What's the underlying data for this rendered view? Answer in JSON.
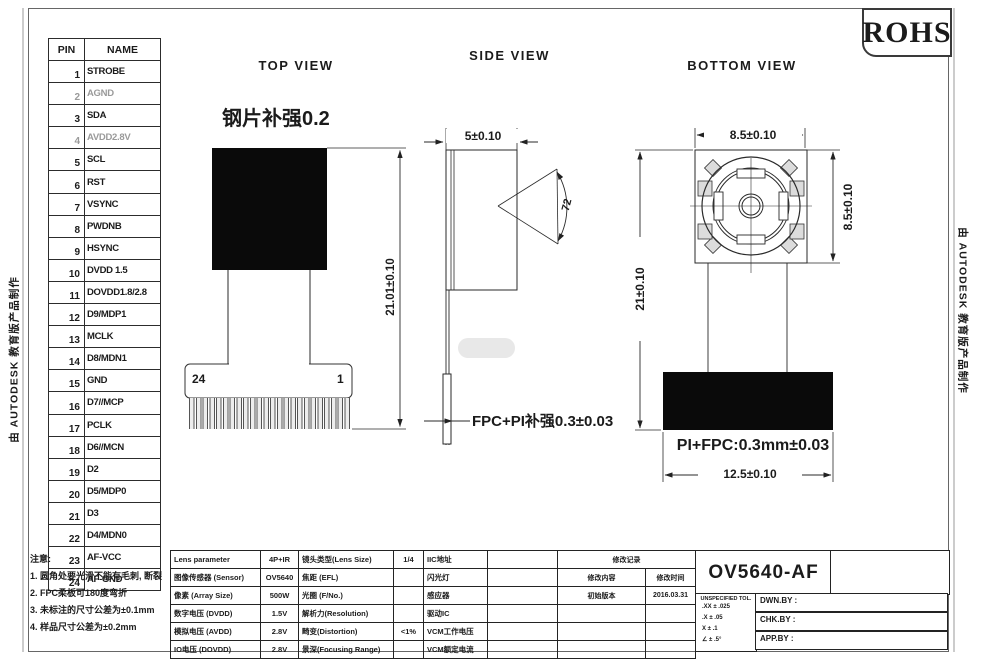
{
  "badge": {
    "rohs": "ROHS"
  },
  "watermarks": {
    "left": "由 AUTODESK 教育版产品制作",
    "right": "由 AUTODESK 教育版产品制作"
  },
  "pin_table": {
    "pin_header": "PIN",
    "name_header": "NAME",
    "muted_pins": [
      "2",
      "4"
    ],
    "rows": [
      {
        "pin": "1",
        "name": "STROBE"
      },
      {
        "pin": "2",
        "name": "AGND"
      },
      {
        "pin": "3",
        "name": "SDA"
      },
      {
        "pin": "4",
        "name": "AVDD2.8V"
      },
      {
        "pin": "5",
        "name": "SCL"
      },
      {
        "pin": "6",
        "name": "RST"
      },
      {
        "pin": "7",
        "name": "VSYNC"
      },
      {
        "pin": "8",
        "name": "PWDNB"
      },
      {
        "pin": "9",
        "name": "HSYNC"
      },
      {
        "pin": "10",
        "name": "DVDD 1.5"
      },
      {
        "pin": "11",
        "name": "DOVDD1.8/2.8"
      },
      {
        "pin": "12",
        "name": "D9/MDP1"
      },
      {
        "pin": "13",
        "name": "MCLK"
      },
      {
        "pin": "14",
        "name": "D8/MDN1"
      },
      {
        "pin": "15",
        "name": "GND"
      },
      {
        "pin": "16",
        "name": "D7//MCP"
      },
      {
        "pin": "17",
        "name": "PCLK"
      },
      {
        "pin": "18",
        "name": "D6//MCN"
      },
      {
        "pin": "19",
        "name": "D2"
      },
      {
        "pin": "20",
        "name": "D5/MDP0"
      },
      {
        "pin": "21",
        "name": "D3"
      },
      {
        "pin": "22",
        "name": "D4/MDN0"
      },
      {
        "pin": "23",
        "name": "AF-VCC"
      },
      {
        "pin": "24",
        "name": "AF-GND"
      }
    ]
  },
  "views": {
    "top": {
      "title": "TOP VIEW",
      "stiffener_note": "钢片补强0.2",
      "height_dim": "21.01±0.10",
      "pin24": "24",
      "pin1": "1"
    },
    "side": {
      "title": "SIDE VIEW",
      "width_dim": "5±0.10",
      "fov_deg": "72",
      "fpc_note": "FPC+PI补强0.3±0.03"
    },
    "bottom": {
      "title": "BOTTOM VIEW",
      "width_dim": "8.5±0.10",
      "height_dim": "8.5±0.10",
      "total_height_dim": "21±0.10",
      "fpc_note": "PI+FPC:0.3mm±0.03",
      "base_width_dim": "12.5±0.10"
    }
  },
  "notes": {
    "title": "注意:",
    "items": [
      "1. 圆角处要光滑不能有毛刺, 断裂",
      "2. FPC柔板可180度弯折",
      "3. 未标注的尺寸公差为±0.1mm",
      "4. 样品尺寸公差为±0.2mm"
    ]
  },
  "spec_table": {
    "rows": [
      [
        "Lens parameter",
        "4P+IR",
        "镜头类型(Lens Size)",
        "1/4",
        "IIC地址",
        ""
      ],
      [
        "图像传感器 (Sensor)",
        "OV5640",
        "焦距 (EFL)",
        "",
        "闪光灯",
        ""
      ],
      [
        "像素 (Array Size)",
        "500W",
        "光圈 (F/No.)",
        "",
        "感应器",
        ""
      ],
      [
        "数字电压 (DVDD)",
        "1.5V",
        "解析力(Resolution)",
        "",
        "驱动IC",
        ""
      ],
      [
        "模拟电压 (AVDD)",
        "2.8V",
        "畸变(Distortion)",
        "<1%",
        "VCM工作电压",
        ""
      ],
      [
        "IO电压 (DOVDD)",
        "2.8V",
        "景深(Focusing Range)",
        "",
        "VCM额定电流",
        ""
      ]
    ]
  },
  "revision": {
    "rows": [
      {
        "colspan": 2,
        "cells": [
          "修改记录"
        ]
      },
      {
        "cells": [
          "修改内容",
          "修改时间"
        ]
      },
      {
        "cells": [
          "初始版本",
          "2016.03.31"
        ]
      },
      {
        "cells": [
          "",
          ""
        ]
      },
      {
        "cells": [
          "",
          ""
        ]
      },
      {
        "cells": [
          "",
          ""
        ]
      }
    ]
  },
  "title_block": {
    "part_no": "OV5640-AF",
    "tol_header": "UNSPECIFIED TOL.",
    "tol_rows": [
      ".XX ± .025",
      ".X ± .05",
      "X ± .1",
      "∠ ± .5°"
    ],
    "drawn_label": "DWN.BY :",
    "checked_label": "CHK.BY :",
    "approved_label": "APP.BY :"
  }
}
